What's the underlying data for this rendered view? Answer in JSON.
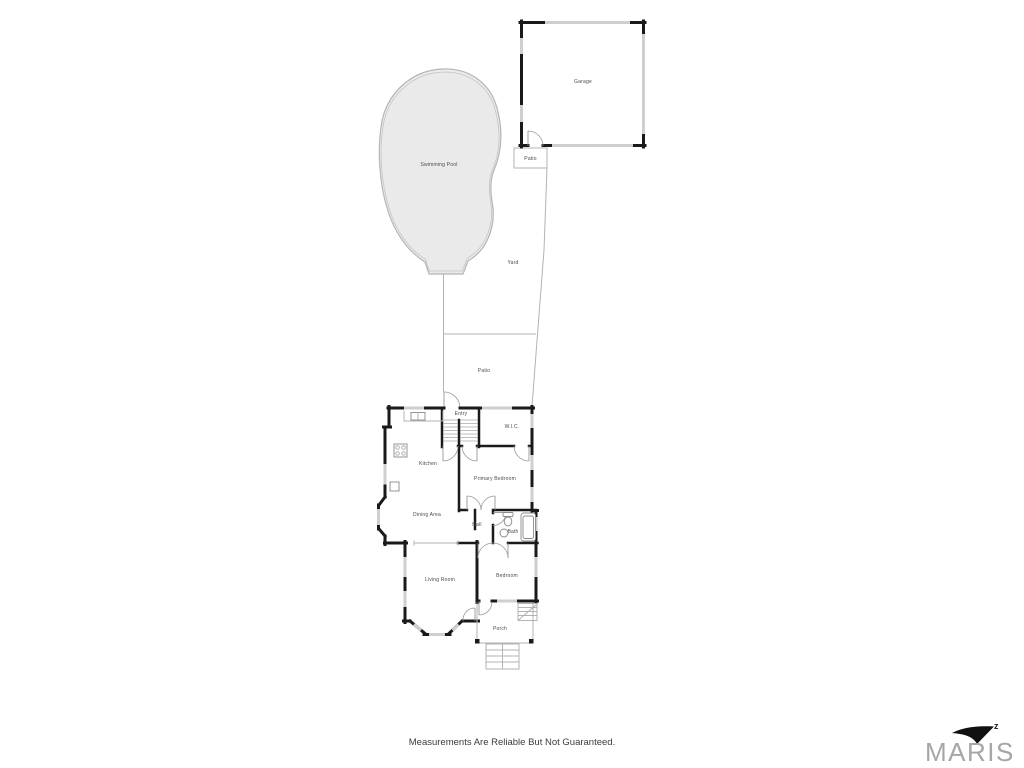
{
  "plan": {
    "rooms": {
      "swimming_pool": "Swimming Pool",
      "garage": "Garage",
      "patio_garage": "Patio",
      "yard": "Yard",
      "patio_house": "Patio",
      "entry": "Entry",
      "wic": "W.I.C.",
      "kitchen": "Kitchen",
      "primary_bedroom": "Primary Bedroom",
      "dining_area": "Dining Area",
      "hall": "Hall",
      "bath": "Bath",
      "living_room": "Living Room",
      "bedroom": "Bedroom",
      "porch": "Porch"
    },
    "disclaimer": "Measurements Are Reliable But Not Guaranteed.",
    "brand": {
      "name": "MARIS",
      "mark": "z"
    },
    "colors": {
      "wall": "#1a1a1a",
      "window": "#cfcfcf",
      "boundary": "#b3b3b3",
      "pool_fill": "#eaeaea",
      "pool_stroke": "#b5b5b5",
      "label_text": "#4a4a4a",
      "disclaimer_text": "#3b3b3b",
      "brand_gray": "#a6a6a6"
    }
  }
}
